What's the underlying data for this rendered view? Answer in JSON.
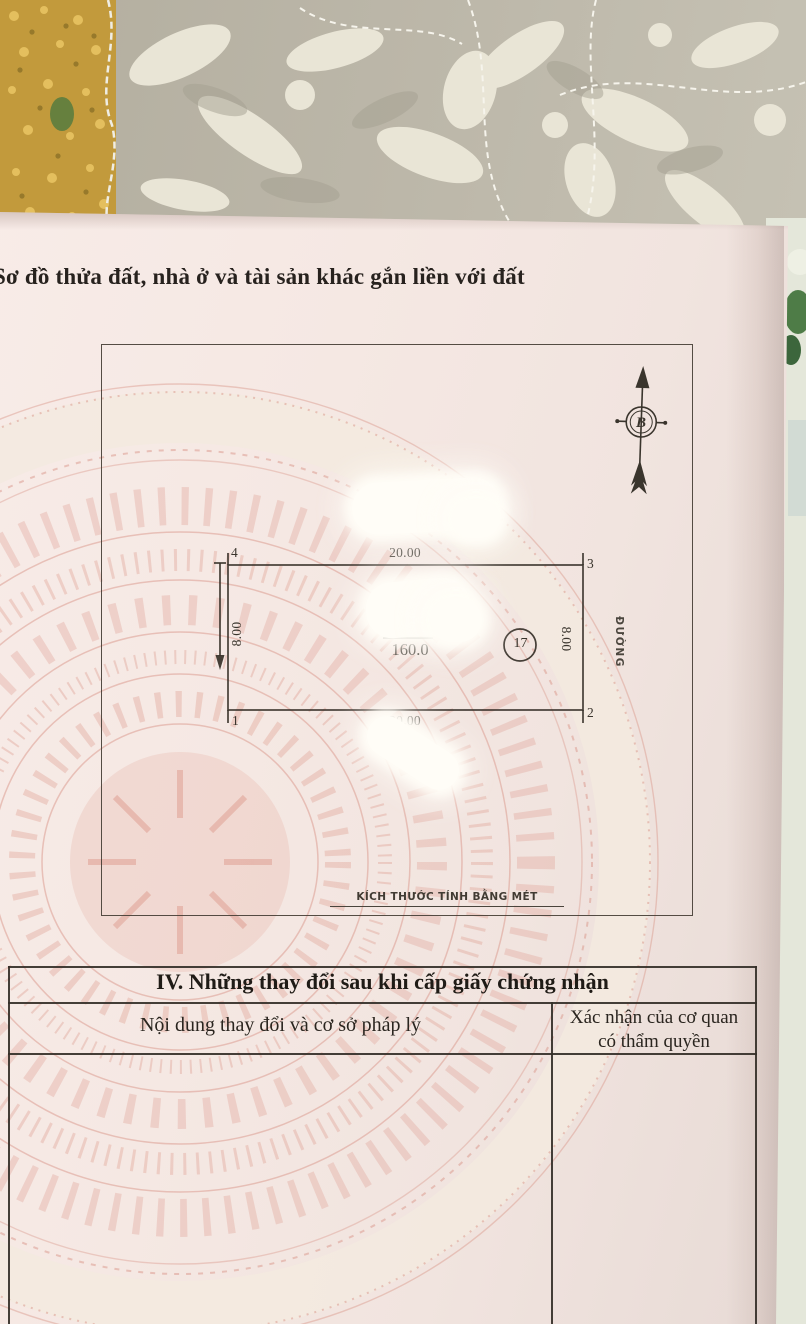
{
  "document": {
    "section_title": "Sơ đồ thửa đất, nhà ở và tài sản khác gắn liền với đất",
    "diagram": {
      "north_label": "B",
      "road_label": "ĐƯỜNG",
      "scale_note": "KÍCH THƯỚC TÍNH BẰNG MÉT",
      "parcel": {
        "corner_top_left": "4",
        "corner_top_right": "3",
        "corner_bottom_right": "2",
        "corner_bottom_left": "1",
        "top_edge_length": "20.00",
        "bottom_edge_length": "20.00",
        "left_edge_length": "8.00",
        "right_edge_length": "8.00",
        "area": "160.0",
        "parcel_number": "17"
      }
    },
    "changes_table": {
      "title": "IV. Những thay đổi sau khi cấp giấy chứng nhận",
      "col1_header": "Nội dung thay đổi và cơ sở pháp lý",
      "col2_header_line1": "Xác nhận của cơ quan",
      "col2_header_line2": "có thẩm quyền"
    },
    "colors": {
      "paper": "#f5e9e4",
      "watermark_pink": "#dd9e92",
      "ink": "#37322a",
      "fabric_taupe": "#b7b2a4",
      "fabric_cream": "#e9e5d6",
      "patch_yellow": "#c29a3c"
    }
  }
}
